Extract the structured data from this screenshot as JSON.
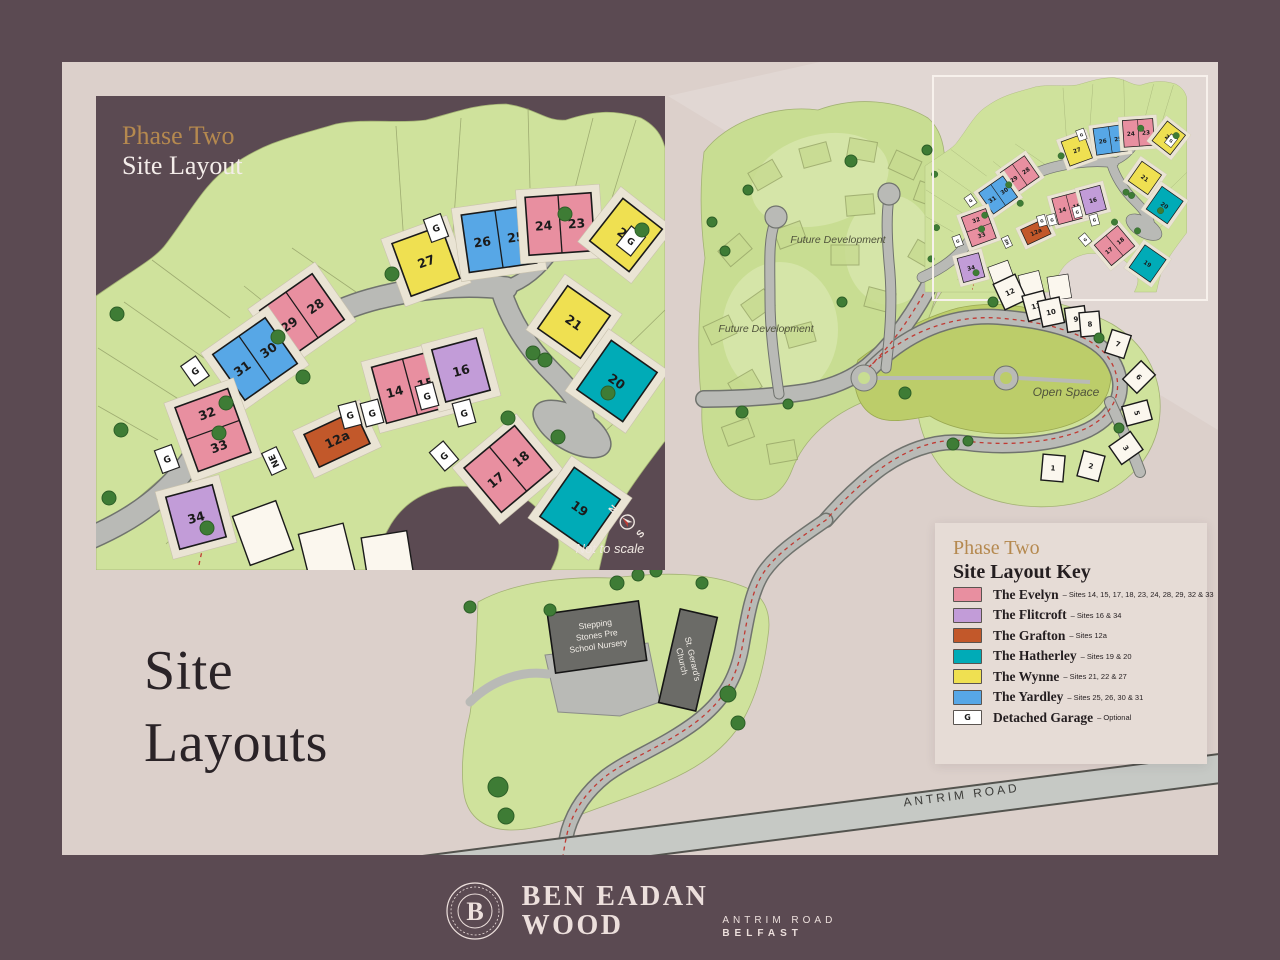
{
  "page": {
    "title_line1": "Site",
    "title_line2": "Layouts"
  },
  "inset": {
    "title_accent": "Phase Two",
    "title_main": "Site Layout",
    "not_to_scale": "Not to scale",
    "compass_n": "N",
    "compass_s": "S",
    "substation_label": "NE"
  },
  "legend": {
    "title_accent": "Phase Two",
    "title_main": "Site Layout Key",
    "entries": [
      {
        "type": "evelyn",
        "name": "The Evelyn",
        "sites": "– Sites 14, 15, 17, 18, 23, 24, 28, 29, 32 & 33",
        "color": "#e88fa0"
      },
      {
        "type": "flitcroft",
        "name": "The Flitcroft",
        "sites": "– Sites 16 & 34",
        "color": "#c29cd8"
      },
      {
        "type": "grafton",
        "name": "The Grafton",
        "sites": "– Sites 12a",
        "color": "#c2582a"
      },
      {
        "type": "hatherley",
        "name": "The Hatherley",
        "sites": "– Sites 19 & 20",
        "color": "#00abb7"
      },
      {
        "type": "wynne",
        "name": "The Wynne",
        "sites": "– Sites 21, 22 & 27",
        "color": "#efe051"
      },
      {
        "type": "yardley",
        "name": "The Yardley",
        "sites": "– Sites 25, 26, 30 & 31",
        "color": "#57a7e6"
      },
      {
        "type": "garage",
        "name": "Detached Garage",
        "sites": "– Optional",
        "color": "#ffffff",
        "glyph": "G"
      }
    ]
  },
  "overview": {
    "future_development": "Future Development",
    "open_space": "Open Space",
    "nursery": [
      "Stepping",
      "Stones Pre",
      "School Nursery"
    ],
    "church": [
      "St. Gerard's",
      "Church"
    ],
    "antrim_road": "ANTRIM ROAD"
  },
  "footer": {
    "brand_line1": "BEN EADAN",
    "brand_line2": "WOOD",
    "address_line1": "ANTRIM ROAD",
    "address_line2": "BELFAST",
    "badge_letter": "B"
  },
  "colors": {
    "plum": "#5b4a52",
    "panel": "#dcd0cb",
    "green": "#cfe29c",
    "open_space": "#bccd6a",
    "road": "#b9bab6",
    "gold": "#b5894f",
    "red_route": "#c03a33"
  },
  "phase2_map": {
    "houses": [
      {
        "labels": [
          "27"
        ],
        "type": "wynne",
        "x": 330,
        "y": 165,
        "w": 52,
        "h": 56,
        "r": -20
      },
      {
        "labels": [
          "26",
          "25"
        ],
        "type": "yardley",
        "x": 403,
        "y": 143,
        "w": 68,
        "h": 58,
        "r": -8,
        "split": "v"
      },
      {
        "labels": [
          "24",
          "23"
        ],
        "type": "evelyn",
        "x": 464,
        "y": 128,
        "w": 66,
        "h": 58,
        "r": -4,
        "split": "v"
      },
      {
        "labels": [
          "22"
        ],
        "type": "wynne",
        "x": 530,
        "y": 139,
        "w": 50,
        "h": 54,
        "r": 38
      },
      {
        "labels": [
          "21"
        ],
        "type": "wynne",
        "x": 478,
        "y": 226,
        "w": 52,
        "h": 52,
        "r": 35
      },
      {
        "labels": [
          "20"
        ],
        "type": "hatherley",
        "x": 521,
        "y": 285,
        "w": 56,
        "h": 60,
        "r": 35
      },
      {
        "labels": [
          "29",
          "28"
        ],
        "type": "evelyn",
        "x": 206,
        "y": 219,
        "w": 64,
        "h": 56,
        "r": -35,
        "split": "v"
      },
      {
        "labels": [
          "31",
          "30"
        ],
        "type": "yardley",
        "x": 159,
        "y": 263,
        "w": 64,
        "h": 56,
        "r": -35,
        "split": "v"
      },
      {
        "labels": [
          "32",
          "33"
        ],
        "type": "evelyn",
        "x": 117,
        "y": 334,
        "w": 56,
        "h": 68,
        "r": -20,
        "split": "h"
      },
      {
        "labels": [
          "34"
        ],
        "type": "flitcroft",
        "x": 100,
        "y": 421,
        "w": 48,
        "h": 54,
        "r": -15
      },
      {
        "labels": [
          "12a"
        ],
        "type": "grafton",
        "x": 241,
        "y": 343,
        "w": 56,
        "h": 36,
        "r": -25,
        "light_text": true
      },
      {
        "labels": [
          "14",
          "15"
        ],
        "type": "evelyn",
        "x": 314,
        "y": 291,
        "w": 64,
        "h": 58,
        "r": -15,
        "split": "v"
      },
      {
        "labels": [
          "16"
        ],
        "type": "flitcroft",
        "x": 365,
        "y": 274,
        "w": 46,
        "h": 54,
        "r": -15
      },
      {
        "labels": [
          "17",
          "18"
        ],
        "type": "evelyn",
        "x": 412,
        "y": 373,
        "w": 66,
        "h": 58,
        "r": -40,
        "split": "v"
      },
      {
        "labels": [
          "19"
        ],
        "type": "hatherley",
        "x": 484,
        "y": 412,
        "w": 56,
        "h": 60,
        "r": 35
      }
    ],
    "garages": [
      {
        "x": 340,
        "y": 132,
        "r": -20
      },
      {
        "x": 535,
        "y": 145,
        "r": 38
      },
      {
        "x": 99,
        "y": 275,
        "r": -35
      },
      {
        "x": 71,
        "y": 363,
        "r": -20
      },
      {
        "x": 254,
        "y": 319,
        "r": -15
      },
      {
        "x": 276,
        "y": 317,
        "r": -15
      },
      {
        "x": 331,
        "y": 300,
        "r": -15
      },
      {
        "x": 368,
        "y": 317,
        "r": -15
      },
      {
        "x": 348,
        "y": 360,
        "r": -40
      }
    ],
    "white_houses": [
      {
        "x": 167,
        "y": 437,
        "r": -20
      },
      {
        "x": 231,
        "y": 458,
        "r": -14
      },
      {
        "x": 292,
        "y": 464,
        "r": -9
      }
    ],
    "substation": {
      "x": 178,
      "y": 365,
      "r": -25
    },
    "trees": [
      [
        296,
        178
      ],
      [
        182,
        241
      ],
      [
        207,
        281
      ],
      [
        130,
        307
      ],
      [
        123,
        337
      ],
      [
        25,
        334
      ],
      [
        13,
        402
      ],
      [
        469,
        118
      ],
      [
        546,
        134
      ],
      [
        437,
        257
      ],
      [
        449,
        264
      ],
      [
        512,
        297
      ],
      [
        462,
        341
      ],
      [
        412,
        322
      ],
      [
        21,
        218
      ],
      [
        111,
        432
      ]
    ]
  },
  "overview_map": {
    "phase1_houses": [
      {
        "label": "12",
        "x": 1010,
        "y": 292,
        "r": -25,
        "w": 24,
        "h": 28
      },
      {
        "label": "11",
        "x": 1036,
        "y": 306,
        "r": -15,
        "w": 22,
        "h": 26
      },
      {
        "label": "10",
        "x": 1051,
        "y": 312,
        "r": -12,
        "w": 22,
        "h": 26
      },
      {
        "label": "9",
        "x": 1076,
        "y": 319,
        "r": -8,
        "w": 20,
        "h": 24
      },
      {
        "label": "8",
        "x": 1090,
        "y": 324,
        "r": -5,
        "w": 20,
        "h": 24
      },
      {
        "label": "7",
        "x": 1118,
        "y": 344,
        "r": 18,
        "w": 20,
        "h": 24
      },
      {
        "label": "6",
        "x": 1139,
        "y": 377,
        "r": 45,
        "w": 20,
        "h": 26
      },
      {
        "label": "5",
        "x": 1137,
        "y": 413,
        "r": 75,
        "w": 20,
        "h": 26
      },
      {
        "label": "3",
        "x": 1126,
        "y": 448,
        "r": 55,
        "w": 22,
        "h": 26
      },
      {
        "label": "2",
        "x": 1091,
        "y": 466,
        "r": 15,
        "w": 22,
        "h": 26
      },
      {
        "label": "1",
        "x": 1053,
        "y": 468,
        "r": 5,
        "w": 22,
        "h": 26
      }
    ],
    "ghost_houses": [
      [
        765,
        175,
        -30
      ],
      [
        815,
        155,
        -15
      ],
      [
        862,
        150,
        10
      ],
      [
        905,
        165,
        25
      ],
      [
        790,
        235,
        -20
      ],
      [
        845,
        255,
        0
      ],
      [
        758,
        305,
        -35
      ],
      [
        800,
        335,
        -15
      ],
      [
        745,
        385,
        -30
      ],
      [
        880,
        300,
        15
      ],
      [
        925,
        255,
        30
      ],
      [
        930,
        195,
        20
      ],
      [
        860,
        205,
        -5
      ],
      [
        735,
        250,
        -40
      ],
      [
        720,
        330,
        -25
      ],
      [
        738,
        432,
        -20
      ],
      [
        782,
        452,
        -10
      ]
    ],
    "trees": [
      [
        905,
        393,
        6
      ],
      [
        953,
        444,
        6
      ],
      [
        993,
        302,
        5
      ],
      [
        842,
        302,
        5
      ],
      [
        788,
        404,
        5
      ],
      [
        742,
        412,
        6
      ],
      [
        725,
        251,
        5
      ],
      [
        851,
        161,
        6
      ],
      [
        927,
        150,
        5
      ],
      [
        1099,
        338,
        5
      ],
      [
        1119,
        428,
        5
      ],
      [
        968,
        441,
        5
      ],
      [
        712,
        222,
        5
      ],
      [
        748,
        190,
        5
      ],
      [
        617,
        583,
        7
      ],
      [
        638,
        575,
        6
      ],
      [
        656,
        571,
        6
      ],
      [
        702,
        583,
        6
      ],
      [
        728,
        694,
        8
      ],
      [
        738,
        723,
        7
      ],
      [
        498,
        787,
        10
      ],
      [
        506,
        816,
        8
      ],
      [
        550,
        610,
        6
      ],
      [
        470,
        607,
        6
      ]
    ]
  }
}
